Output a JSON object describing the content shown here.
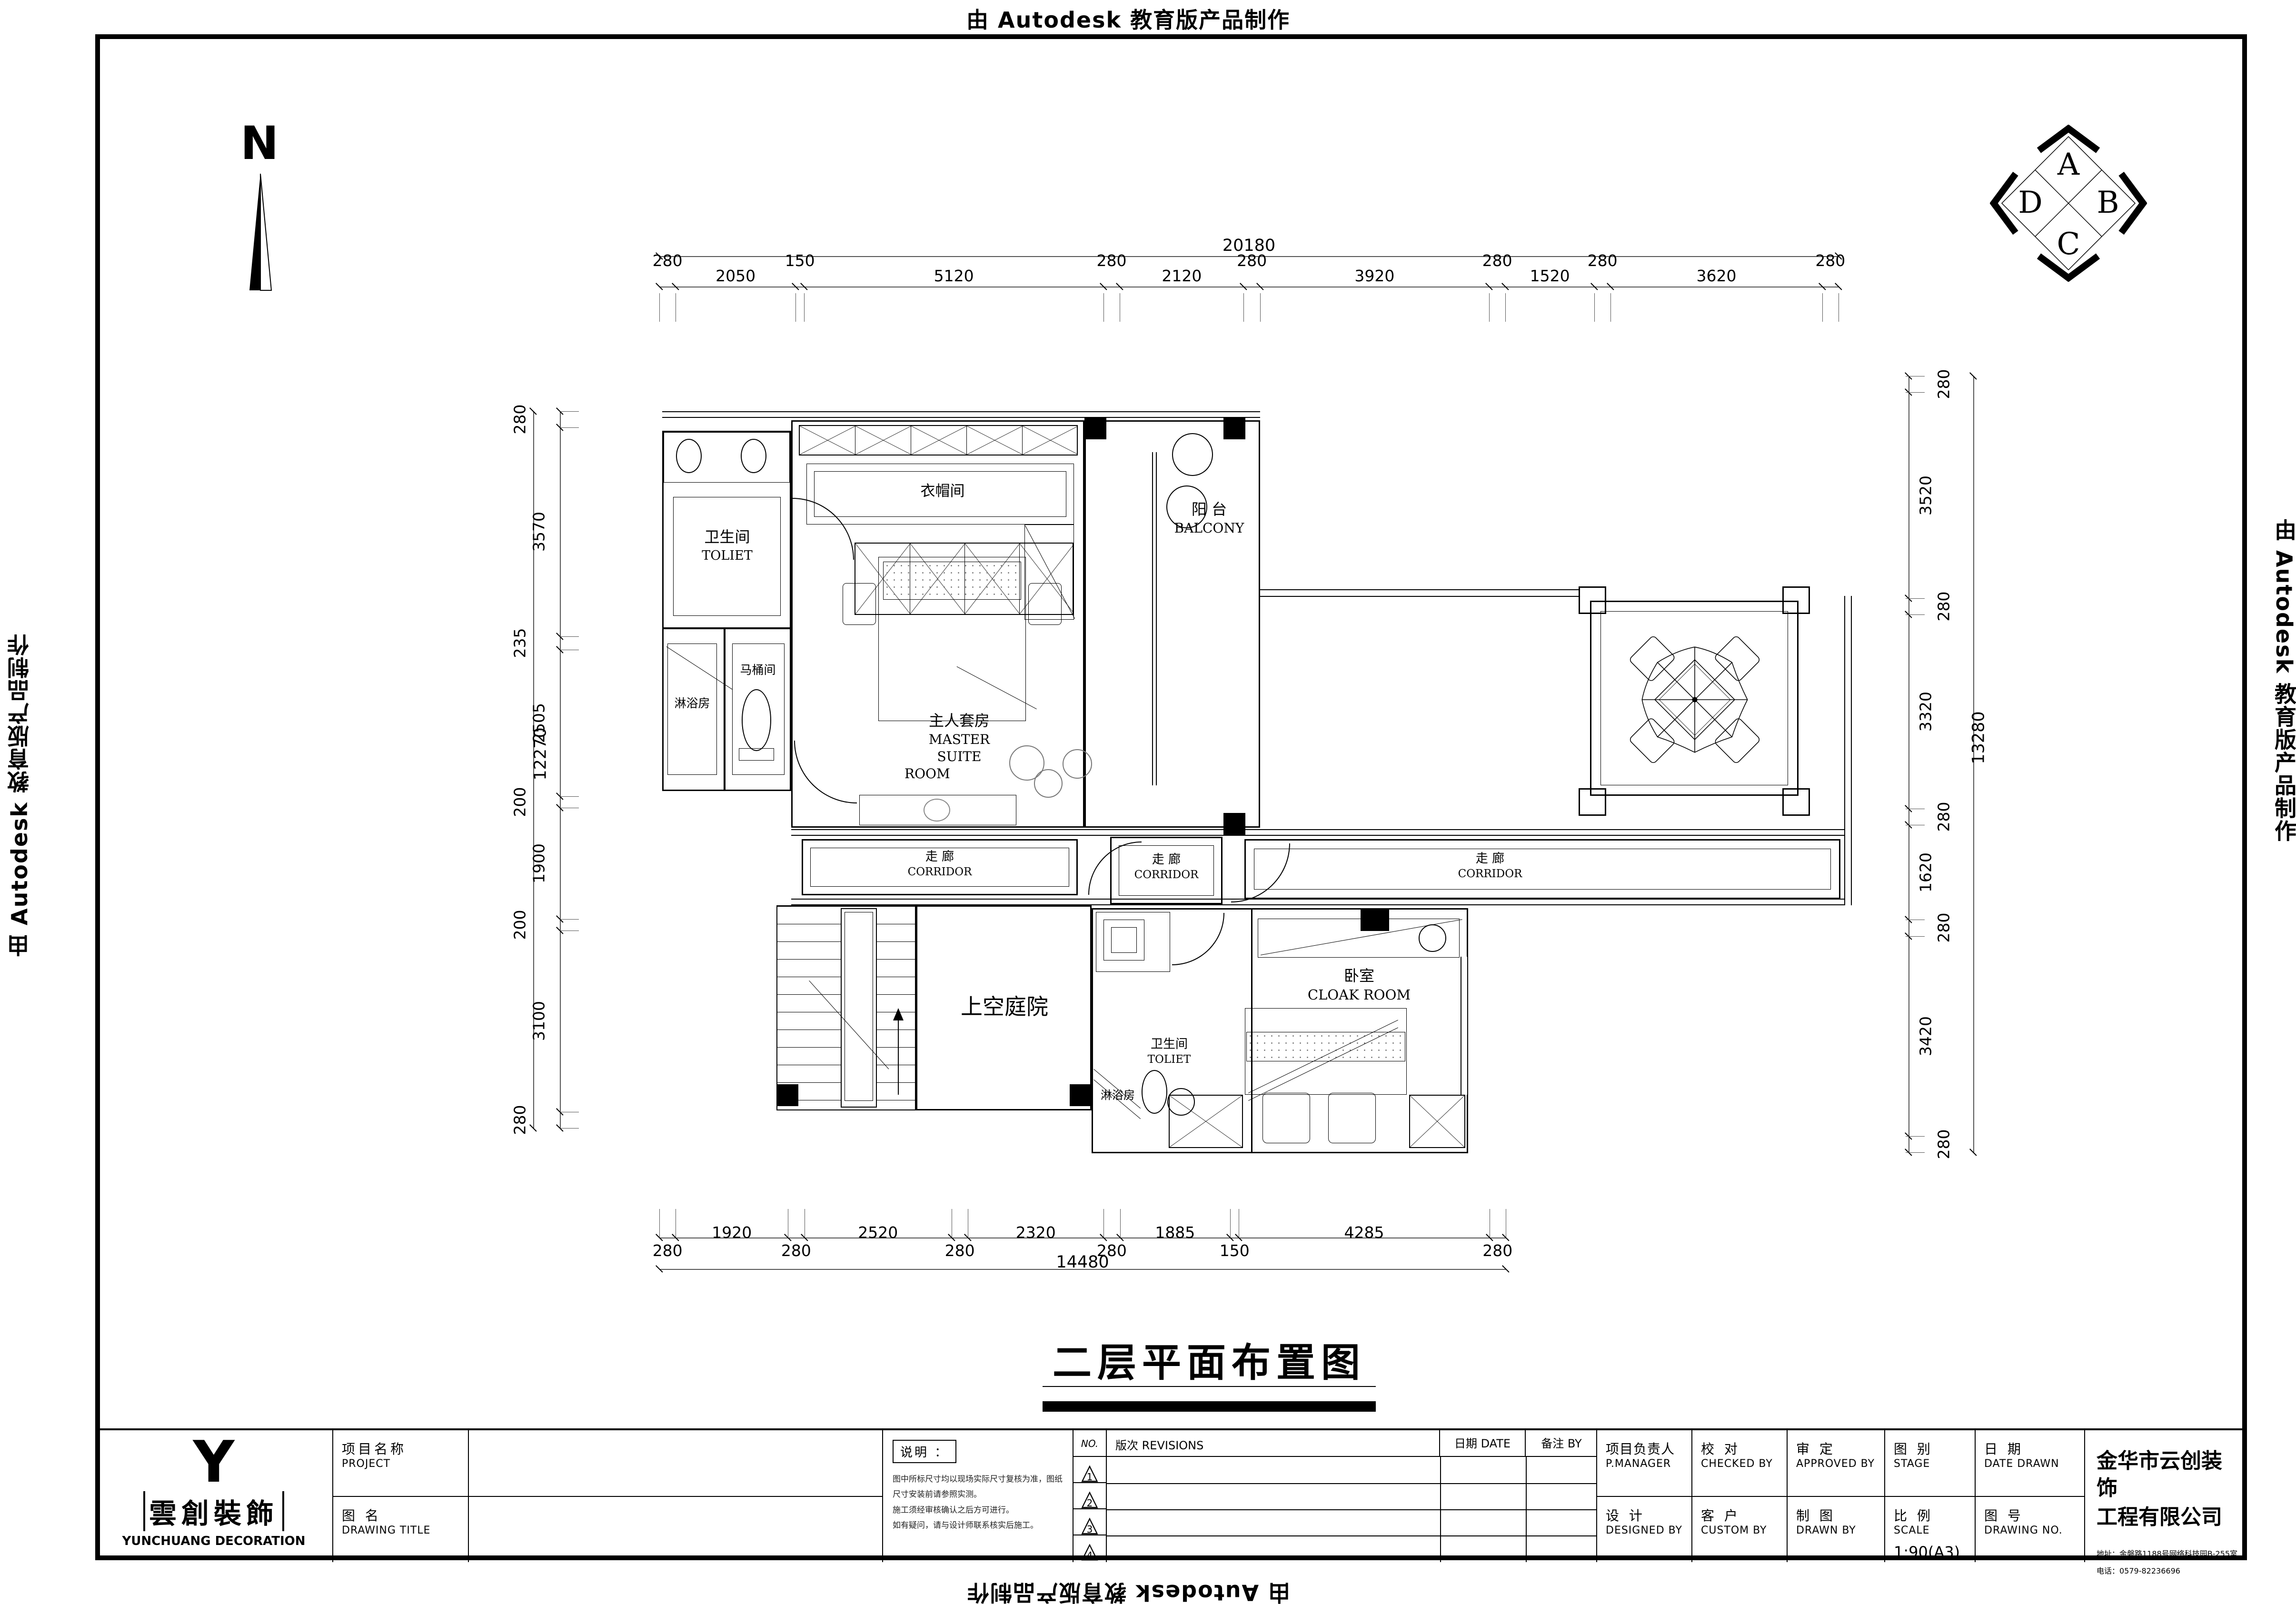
{
  "watermark": {
    "text": "由 Autodesk 教育版产品制作"
  },
  "north": {
    "label": "N"
  },
  "elevation_symbol": {
    "top": "A",
    "right": "B",
    "bottom": "C",
    "left": "D"
  },
  "title": {
    "text": "二层平面布置图"
  },
  "rooms": {
    "toilet_upper": {
      "cn": "卫生间",
      "en": "TOLIET"
    },
    "shower_upper": {
      "cn": "淋浴房"
    },
    "wc_stall": {
      "cn": "马桶间"
    },
    "closet": {
      "cn": "衣帽间"
    },
    "master": {
      "cn": "主人套房",
      "en1": "MASTER  SUITE",
      "en2": "ROOM"
    },
    "balcony": {
      "cn": "阳 台",
      "en": "BALCONY"
    },
    "corridor_left": {
      "cn": "走 廊",
      "en": "CORRIDOR"
    },
    "corridor_mid": {
      "cn": "走 廊",
      "en": "CORRIDOR"
    },
    "corridor_right": {
      "cn": "走 廊",
      "en": "CORRIDOR"
    },
    "courtyard": {
      "cn": "上空庭院"
    },
    "bedroom": {
      "cn": "卧室",
      "en": "CLOAK  ROOM"
    },
    "toilet_lower": {
      "cn": "卫生间",
      "en": "TOLIET"
    },
    "shower_lower": {
      "cn": "淋浴房"
    }
  },
  "dimensions": {
    "top": {
      "segments": [
        280,
        2050,
        150,
        5120,
        280,
        2120,
        280,
        3920,
        280,
        1520,
        280,
        3620,
        280
      ],
      "total": 20180
    },
    "left": {
      "segments": [
        280,
        3570,
        235,
        2505,
        200,
        1900,
        200,
        3100,
        280
      ],
      "total": 12270
    },
    "right": {
      "segments": [
        280,
        3520,
        280,
        3320,
        280,
        1620,
        280,
        3420,
        280
      ],
      "total": 13280
    },
    "bottom": {
      "segments": [
        280,
        1920,
        280,
        2520,
        280,
        2320,
        280,
        1885,
        150,
        4285,
        280
      ],
      "total": 14480
    }
  },
  "titleblock": {
    "logo": {
      "glyph": "Y",
      "cn": "雲創裝飾",
      "en": "YUNCHUANG  DECORATION"
    },
    "fields": {
      "project": {
        "cn": "项目名称",
        "en": "PROJECT"
      },
      "drawing_title": {
        "cn": "图 名",
        "en": "DRAWING TITLE"
      },
      "notes_label": "说明 ：",
      "notes": [
        "图中所标尺寸均以现场实际尺寸复核为准，图纸尺寸安装前请参照实测。",
        "施工须经审核确认之后方可进行。",
        "如有疑问，请与设计师联系核实后施工。"
      ],
      "rev_no": "NO.",
      "rev": "版次 REVISIONS",
      "rev_date": "日期 DATE",
      "rev_by": "备注  BY",
      "rev_rows": [
        "1",
        "2",
        "3",
        "4"
      ],
      "pm": {
        "cn": "项目负责人",
        "en": "P.MANAGER"
      },
      "checked": {
        "cn": "校 对",
        "en": "CHECKED  BY"
      },
      "approved": {
        "cn": "审 定",
        "en": "APPROVED  BY"
      },
      "stage": {
        "cn": "图 别",
        "en": "STAGE"
      },
      "date_drawn": {
        "cn": "日 期",
        "en": "DATE DRAWN"
      },
      "designed": {
        "cn": "设 计",
        "en": "DESIGNED  BY"
      },
      "custom": {
        "cn": "客 户",
        "en": "CUSTOM  BY"
      },
      "drawn": {
        "cn": "制 图",
        "en": "DRAWN  BY"
      },
      "scale": {
        "cn": "比 例",
        "en": "SCALE",
        "value": "1:90(A3)"
      },
      "drawing_no": {
        "cn": "图 号",
        "en": "DRAWING NO."
      }
    },
    "company": {
      "name1": "金华市云创装饰",
      "name2": "工程有限公司",
      "address": "地址：金磐路1188号网络科技园B-255室",
      "phone": "电话：0579-82236696"
    }
  }
}
